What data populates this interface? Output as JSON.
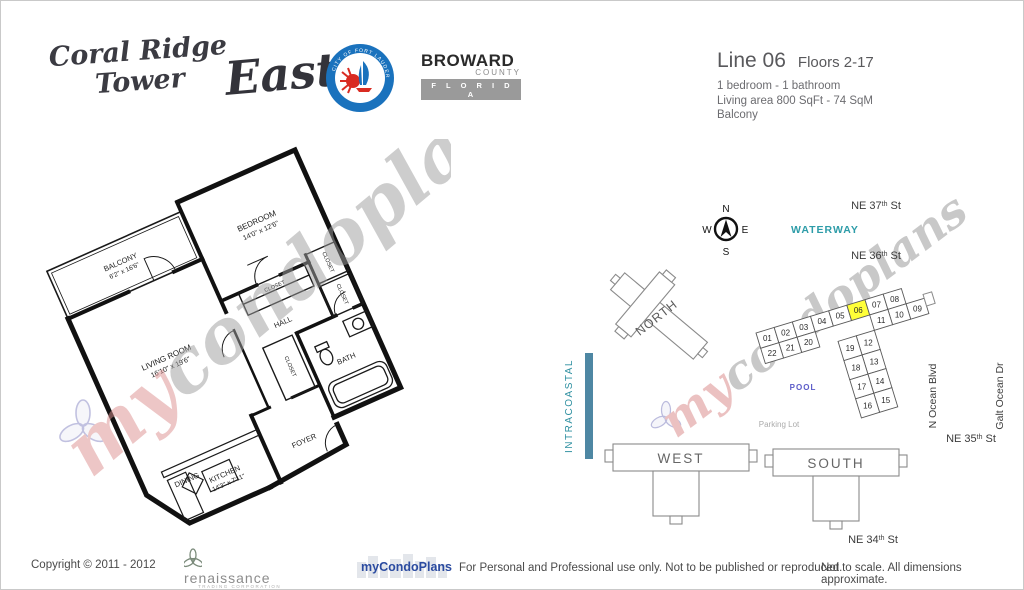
{
  "header": {
    "title_line1": "Coral Ridge",
    "title_line2": "Tower",
    "title_suffix": "East",
    "city_logo": {
      "arc_top": "CITY OF FORT LAUDERDALE",
      "arc_bottom": "VENICE OF AMERICA"
    },
    "county_logo": {
      "name": "BROWARD",
      "sub": "COUNTY",
      "state": "F L O R I D A"
    },
    "unit_info": {
      "line": "Line 06",
      "floors": "Floors 2-17",
      "rooms": "1 bedroom - 1 bathroom",
      "area": "Living area  800  SqFt - 74 SqM",
      "extra": "Balcony"
    }
  },
  "floorplan": {
    "balcony_name": "BALCONY",
    "balcony_dims": "6'2\" x 16'6\"",
    "bedroom_name": "BEDROOM",
    "bedroom_dims": "14'0\" x 12'6\"",
    "living_name": "LIVING ROOM",
    "living_dims": "16'10\" x 19'6\"",
    "kitchen_name": "KITCHEN",
    "kitchen_dims": "14'3\" x 7'11\"",
    "dining": "DINING",
    "foyer": "FOYER",
    "hall": "HALL",
    "bath": "BATH",
    "closet": "CLOSET"
  },
  "map": {
    "compass": {
      "n": "N",
      "s": "S",
      "e": "E",
      "w": "W"
    },
    "streets": {
      "ne37": {
        "pre": "NE 37",
        "sup": "th",
        "post": " St"
      },
      "ne36": {
        "pre": "NE 36",
        "sup": "th",
        "post": " St"
      },
      "ne35": {
        "pre": "NE 35",
        "sup": "th",
        "post": " St"
      },
      "ne34": {
        "pre": "NE 34",
        "sup": "th",
        "post": " St"
      },
      "ocean_blvd": "N Ocean Blvd",
      "galt_ocean": "Galt Ocean Dr"
    },
    "waterway": "WATERWAY",
    "intracoastal": "INTRACOASTAL",
    "pool": "POOL",
    "parking": "Parking Lot",
    "buildings": {
      "north": "NORTH",
      "west": "WEST",
      "south": "SOUTH"
    },
    "units": [
      "01",
      "02",
      "03",
      "04",
      "05",
      "06",
      "07",
      "08",
      "09",
      "10",
      "11",
      "12",
      "13",
      "14",
      "15",
      "16",
      "17",
      "18",
      "19",
      "20",
      "21",
      "22"
    ],
    "highlighted_unit": "06",
    "colors": {
      "highlight": "#FFFF38",
      "waterway_text": "#2D9CA8",
      "intracoastal_text": "#2D8FA0",
      "intracoastal_bar": "#4E87A3",
      "pool_text": "#5B5BC8",
      "parking_text": "#ababab"
    }
  },
  "watermark": {
    "part1": "my",
    "part2": "condoplans"
  },
  "footer": {
    "copyright": "Copyright © 2011 - 2012",
    "renaissance_name": "renaissance",
    "renaissance_sub": "TRADING CORPORATION",
    "brand": "myCondoPlans",
    "usage": "For Personal and Professional use only.  Not to be published or reproduced.",
    "scale_note": "Not to scale.  All dimensions approximate."
  }
}
